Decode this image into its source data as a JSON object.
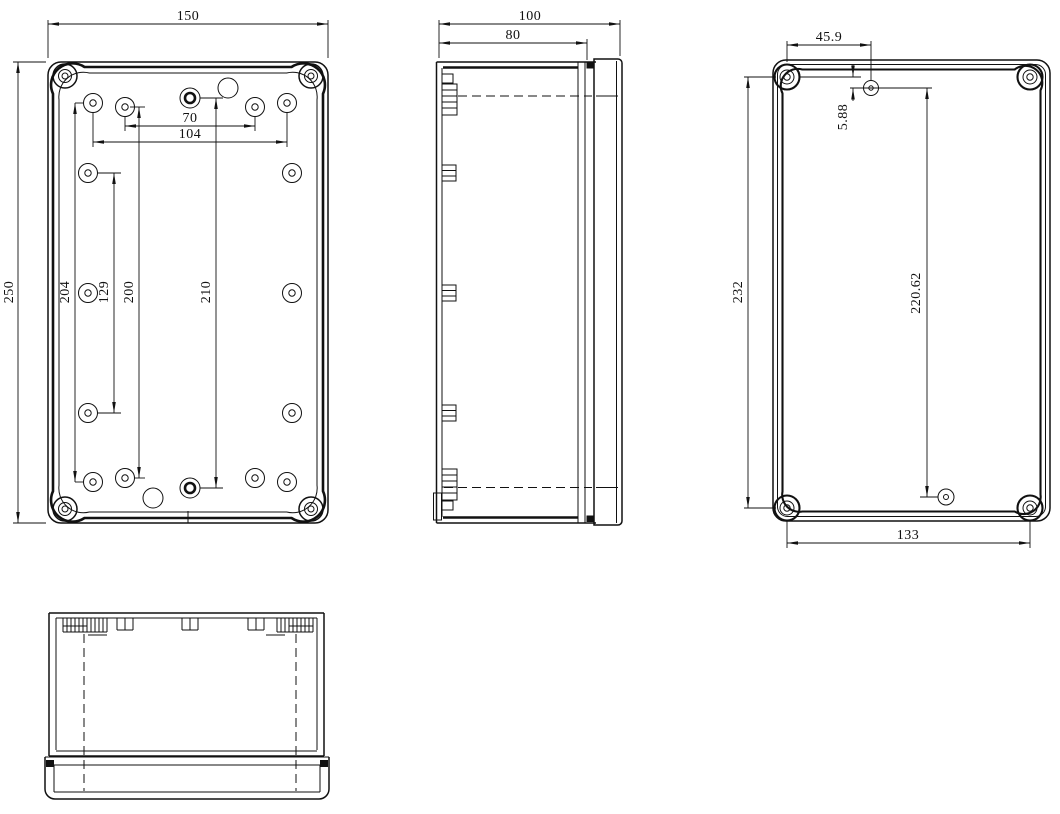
{
  "drawing": {
    "background": "#ffffff",
    "line_color": "#111111",
    "views": {
      "front": {
        "name": "front open view",
        "dims": {
          "width": "150",
          "height": "250",
          "top_holes_inner": "70",
          "top_holes_outer": "104",
          "left_column": "204",
          "inner_column": "129",
          "mid_column": "200",
          "center_column": "210"
        }
      },
      "side": {
        "name": "side view",
        "dims": {
          "total_depth": "100",
          "body_depth": "80"
        }
      },
      "back": {
        "name": "back view",
        "dims": {
          "hole_offset_x": "45.9",
          "hole_offset_y": "5.88",
          "screws_vertical": "232",
          "holes_vertical": "220.62",
          "screws_horizontal": "133"
        }
      },
      "bottom": {
        "name": "front elevation view"
      }
    }
  }
}
